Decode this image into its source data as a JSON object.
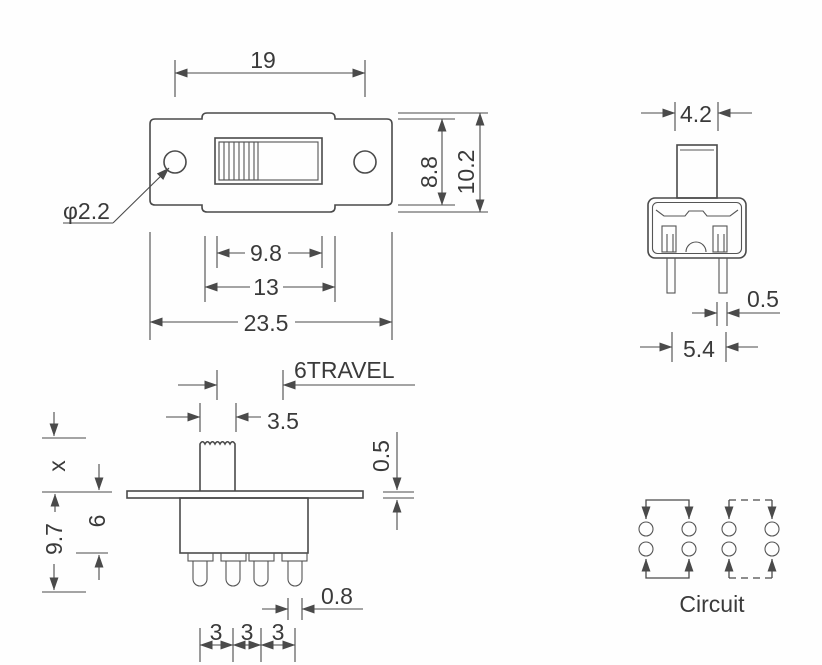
{
  "drawing": {
    "background": "#fefefe",
    "line_color": "#4a4a4a",
    "text_color": "#3a3a3a",
    "top_view": {
      "hole_to_hole": "19",
      "inner_height": "8.8",
      "outer_height": "10.2",
      "hole_diameter": "φ2.2",
      "slot_width": "9.8",
      "frame_width": "13",
      "total_width": "23.5"
    },
    "side_view": {
      "knob_width": "4.2",
      "pin_thickness": "0.5",
      "pin_pitch": "5.4"
    },
    "front_view": {
      "travel": "6TRAVEL",
      "knob_width": "3.5",
      "knob_height": "x",
      "body_height": "6",
      "below_flange": "9.7",
      "flange_thickness": "0.5",
      "pin_width": "0.8",
      "pin_pitch_1": "3",
      "pin_pitch_2": "3",
      "pin_pitch_3": "3"
    },
    "circuit": {
      "label": "Circuit"
    }
  }
}
